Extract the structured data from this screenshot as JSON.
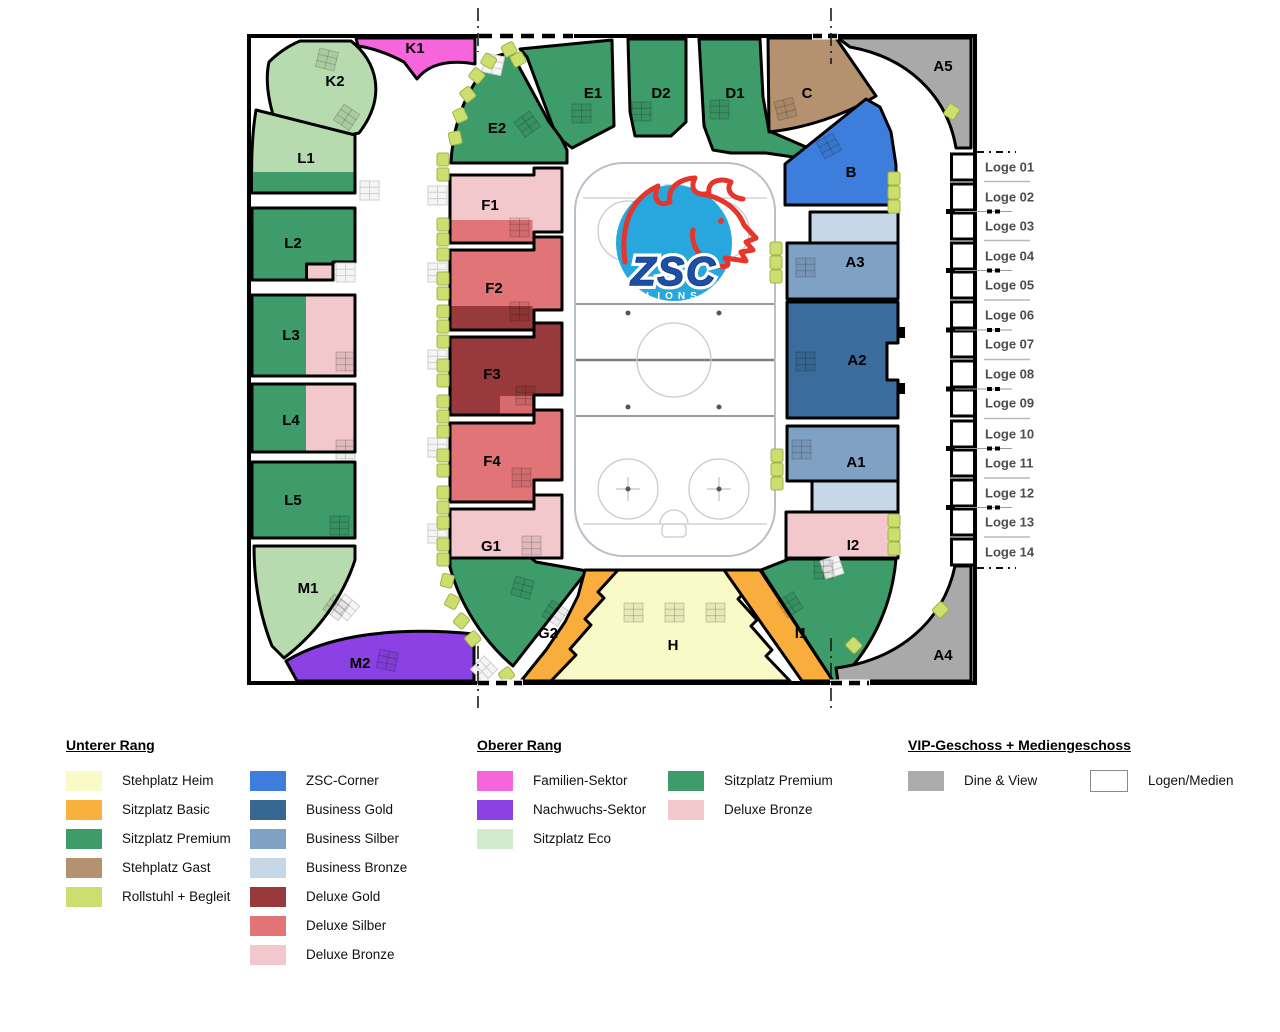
{
  "arena": {
    "sections": {
      "K1": "K1",
      "K2": "K2",
      "L1": "L1",
      "L2": "L2",
      "L3": "L3",
      "L4": "L4",
      "L5": "L5",
      "M1": "M1",
      "M2": "M2",
      "E2": "E2",
      "E1": "E1",
      "D2": "D2",
      "D1": "D1",
      "C": "C",
      "A5": "A5",
      "B": "B",
      "A3": "A3",
      "A2": "A2",
      "A1": "A1",
      "I2": "I2",
      "A4": "A4",
      "F1": "F1",
      "F2": "F2",
      "F3": "F3",
      "F4": "F4",
      "G1": "G1",
      "G2": "G2",
      "H": "H",
      "I1": "I1"
    },
    "loges": [
      "Loge 01",
      "Loge 02",
      "Loge 03",
      "Loge 04",
      "Loge 05",
      "Loge 06",
      "Loge 07",
      "Loge 08",
      "Loge 09",
      "Loge 10",
      "Loge 11",
      "Loge 12",
      "Loge 13",
      "Loge 14"
    ],
    "logo": {
      "team": "ZSC",
      "sub": "LIONS"
    }
  },
  "legend": {
    "groups": [
      {
        "title": "Unterer Rang",
        "columns": [
          [
            {
              "label": "Stehplatz Heim",
              "color": "#FAFAC8"
            },
            {
              "label": "Sitzplatz Basic",
              "color": "#F9B13D"
            },
            {
              "label": "Sitzplatz Premium",
              "color": "#3D9C69"
            },
            {
              "label": "Stehplatz Gast",
              "color": "#B5926F"
            },
            {
              "label": "Rollstuhl + Begleit",
              "color": "#CCDF6E"
            }
          ],
          [
            {
              "label": "ZSC-Corner",
              "color": "#3D7EDC"
            },
            {
              "label": "Business Gold",
              "color": "#376691"
            },
            {
              "label": "Business Silber",
              "color": "#7FA1C4"
            },
            {
              "label": "Business Bronze",
              "color": "#C6D7E8"
            },
            {
              "label": "Deluxe Gold",
              "color": "#983A3B"
            },
            {
              "label": "Deluxe Silber",
              "color": "#E07476"
            },
            {
              "label": "Deluxe Bronze",
              "color": "#F2C8CC"
            }
          ]
        ]
      },
      {
        "title": "Oberer Rang",
        "columns": [
          [
            {
              "label": "Familien-Sektor",
              "color": "#F765DC"
            },
            {
              "label": "Nachwuchs-Sektor",
              "color": "#8B41E4"
            },
            {
              "label": "Sitzplatz Eco",
              "color": "#D3EAD0"
            }
          ],
          [
            {
              "label": "Sitzplatz Premium",
              "color": "#3D9C69"
            },
            {
              "label": "Deluxe Bronze",
              "color": "#F2C8CC"
            }
          ]
        ]
      },
      {
        "title": "VIP-Geschoss + Mediengeschoss",
        "columns": [
          [
            {
              "label": "Dine & View",
              "color": "#ABABAB"
            }
          ],
          [
            {
              "label": "Logen/Medien",
              "color": "#FFFFFF",
              "border": "#8A8A8A"
            }
          ]
        ]
      }
    ]
  }
}
